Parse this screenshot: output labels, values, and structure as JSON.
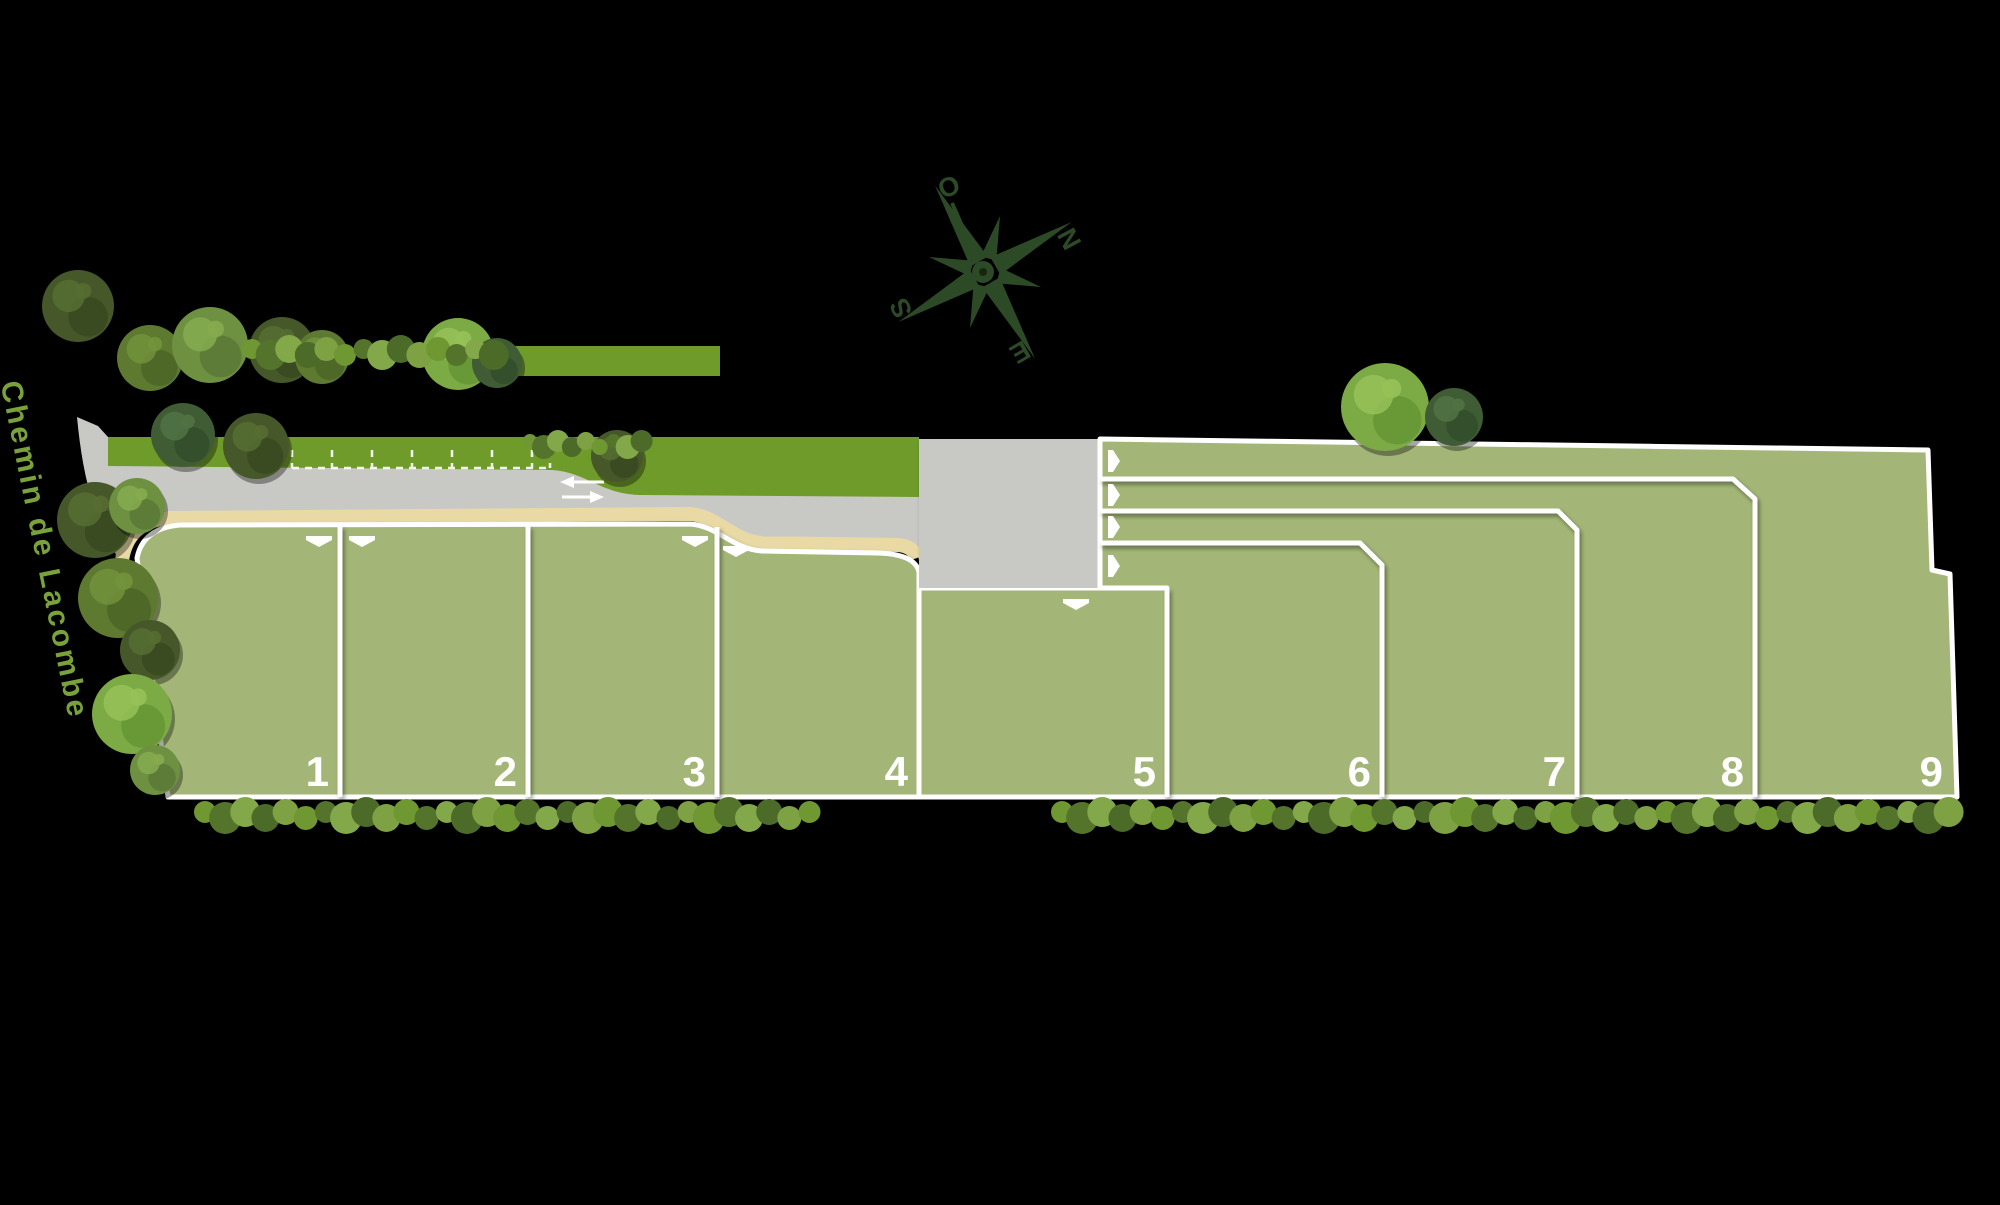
{
  "canvas": {
    "width": 2000,
    "height": 1205,
    "background": "#000000"
  },
  "street": {
    "name": "Chemin de Lacombe",
    "color": "#7aa23b"
  },
  "compass": {
    "color": "#2d4a27",
    "letters": {
      "ouest": "O",
      "nord": "N",
      "sud": "S",
      "est": "E"
    }
  },
  "palette": {
    "lot_fill": "#a4b677",
    "road_fill": "#c8c8c5",
    "grass_verge": "#6f9b2a",
    "sidewalk": "#e9d9a4",
    "border_line": "#ffffff",
    "number_color": "#ffffff",
    "marking_color": "#ffffff"
  },
  "lots": [
    {
      "label": "1",
      "access_arrow": "down"
    },
    {
      "label": "2",
      "access_arrow": "down"
    },
    {
      "label": "3",
      "access_arrow": "down"
    },
    {
      "label": "4",
      "access_arrow": "down"
    },
    {
      "label": "5",
      "access_arrow": "down"
    },
    {
      "label": "6",
      "access_arrow": "right"
    },
    {
      "label": "7",
      "access_arrow": "right"
    },
    {
      "label": "8",
      "access_arrow": "right"
    },
    {
      "label": "9",
      "access_arrow": "right"
    }
  ],
  "road_markings": {
    "parking_bays": 6,
    "direction_arrows": [
      "left",
      "right"
    ]
  },
  "vegetation": {
    "trees": [
      {
        "x": 78,
        "y": 306,
        "r": 36,
        "palette": "dark"
      },
      {
        "x": 150,
        "y": 358,
        "r": 33,
        "palette": "olive"
      },
      {
        "x": 210,
        "y": 345,
        "r": 38,
        "palette": "medium"
      },
      {
        "x": 282,
        "y": 350,
        "r": 33,
        "palette": "dark"
      },
      {
        "x": 322,
        "y": 357,
        "r": 27,
        "palette": "olive"
      },
      {
        "x": 183,
        "y": 435,
        "r": 32,
        "palette": "forest"
      },
      {
        "x": 256,
        "y": 446,
        "r": 33,
        "palette": "dark"
      },
      {
        "x": 458,
        "y": 354,
        "r": 36,
        "palette": "bright"
      },
      {
        "x": 497,
        "y": 363,
        "r": 25,
        "palette": "forest"
      },
      {
        "x": 617,
        "y": 456,
        "r": 26,
        "palette": "dark"
      },
      {
        "x": 1385,
        "y": 407,
        "r": 44,
        "palette": "bright"
      },
      {
        "x": 1454,
        "y": 417,
        "r": 29,
        "palette": "forest"
      },
      {
        "x": 95,
        "y": 520,
        "r": 38,
        "palette": "dark"
      },
      {
        "x": 137,
        "y": 506,
        "r": 28,
        "palette": "medium"
      },
      {
        "x": 118,
        "y": 598,
        "r": 40,
        "palette": "olive"
      },
      {
        "x": 150,
        "y": 650,
        "r": 30,
        "palette": "dark"
      },
      {
        "x": 132,
        "y": 714,
        "r": 40,
        "palette": "bright"
      },
      {
        "x": 155,
        "y": 770,
        "r": 25,
        "palette": "medium"
      }
    ],
    "hedges": [
      {
        "x1": 252,
        "x2": 505,
        "y": 352,
        "r": 12
      },
      {
        "x1": 530,
        "x2": 648,
        "y": 444,
        "r": 9
      },
      {
        "x1": 205,
        "x2": 818,
        "y": 815,
        "r": 13
      },
      {
        "x1": 1062,
        "x2": 1950,
        "y": 815,
        "r": 13
      }
    ]
  }
}
